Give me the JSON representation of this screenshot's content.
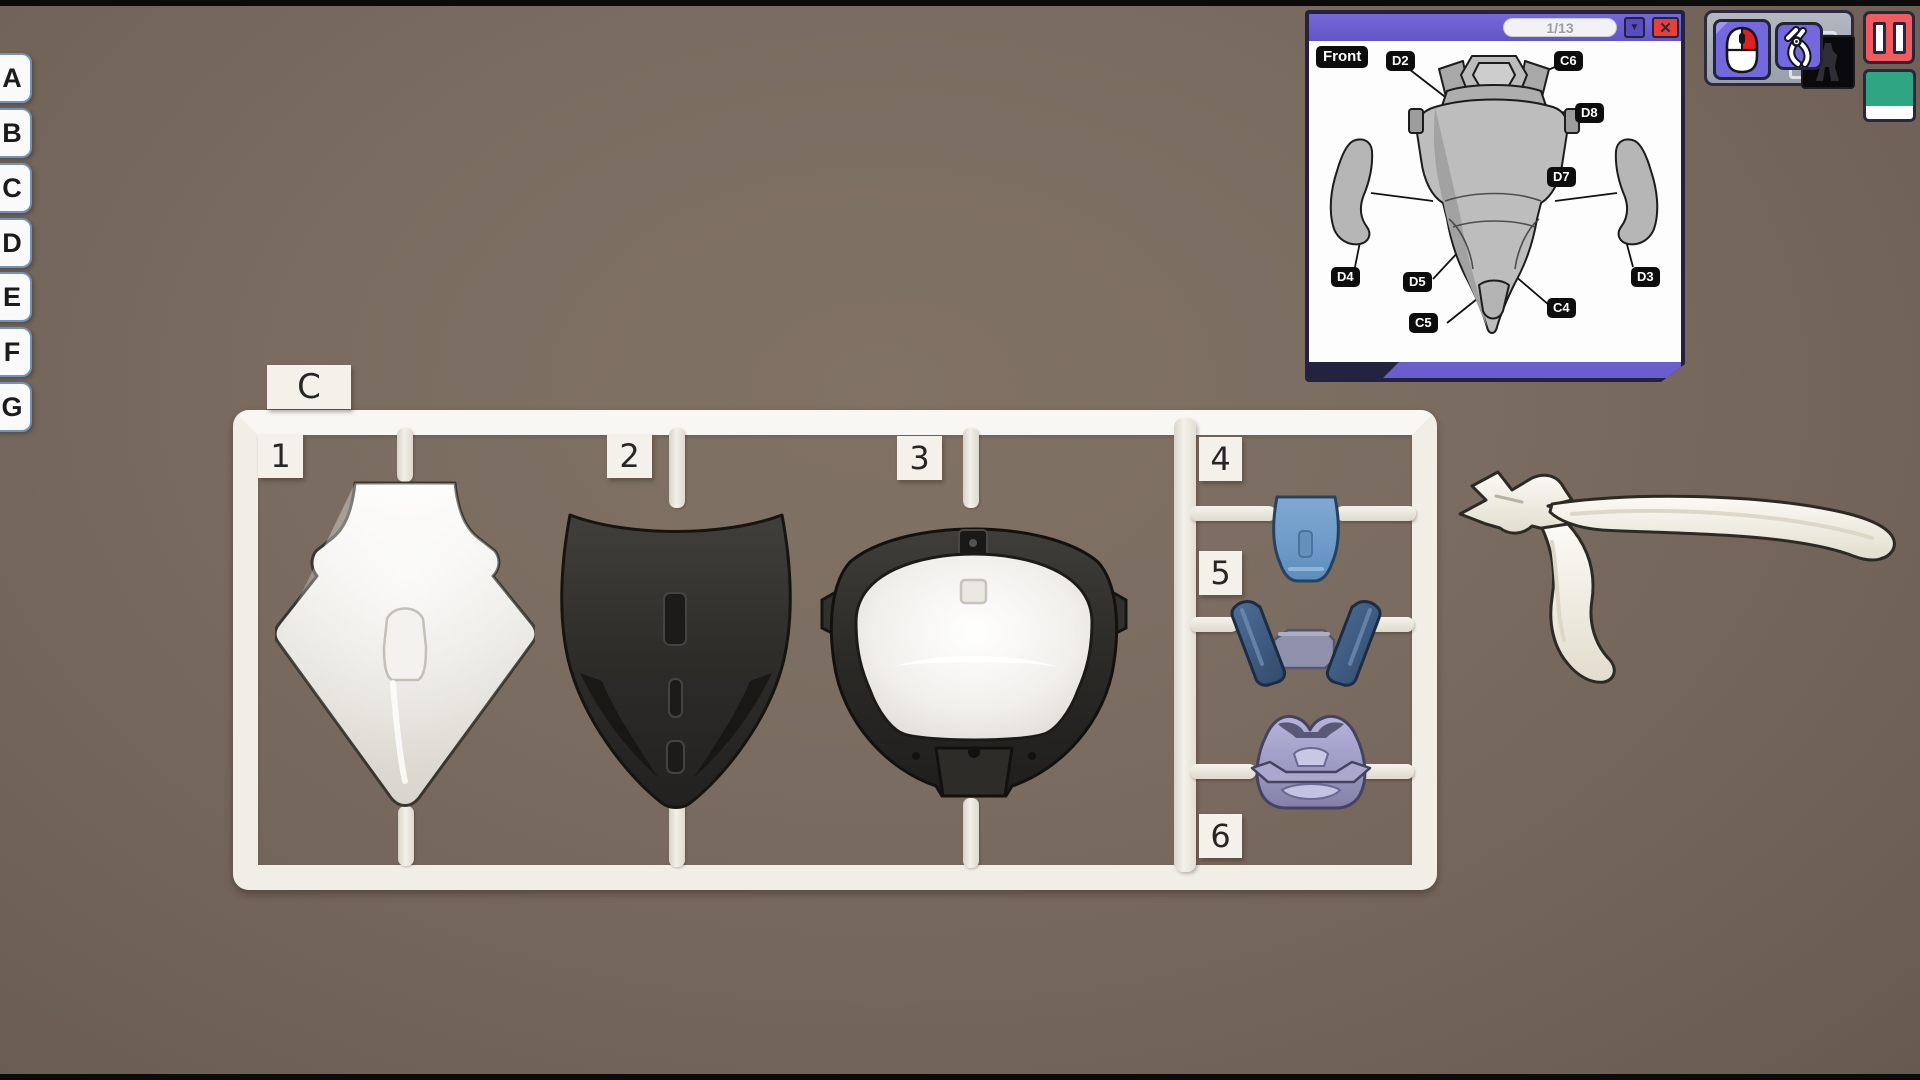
{
  "tabs": {
    "items": [
      "A",
      "B",
      "C",
      "D",
      "E",
      "F",
      "G"
    ]
  },
  "sprue": {
    "runner_label": "C",
    "numbers": [
      "1",
      "2",
      "3",
      "4",
      "5",
      "6"
    ],
    "frame_color": "#f1eee6",
    "part_colors": {
      "part_1": "#e9e7e1",
      "part_2": "#2e2c29",
      "part_3_shell": "#262522",
      "part_3_dome": "#f3f1ed",
      "part_4": "#6d9ac8",
      "part_5_straps": "#40618a",
      "part_5_center": "#8f91ad",
      "part_6": "#9d9bc4"
    }
  },
  "manual": {
    "page_indicator": "1/13",
    "dropdown_glyph": "▼",
    "close_glyph": "✕",
    "view_label": "Front",
    "part_labels": [
      "D2",
      "C6",
      "D8",
      "D7",
      "D4",
      "D5",
      "D3",
      "C4",
      "C5"
    ],
    "header_color": "#6a5ecd",
    "close_color": "#e5403b"
  },
  "hud": {
    "tool_buttons": [
      {
        "icon": "mouse-icon",
        "accent": "#7468dd"
      },
      {
        "icon": "nippers-icon",
        "accent": "#7468dd"
      }
    ],
    "pause_color": "#f15b5e",
    "swatch_color": "#2fa583"
  }
}
